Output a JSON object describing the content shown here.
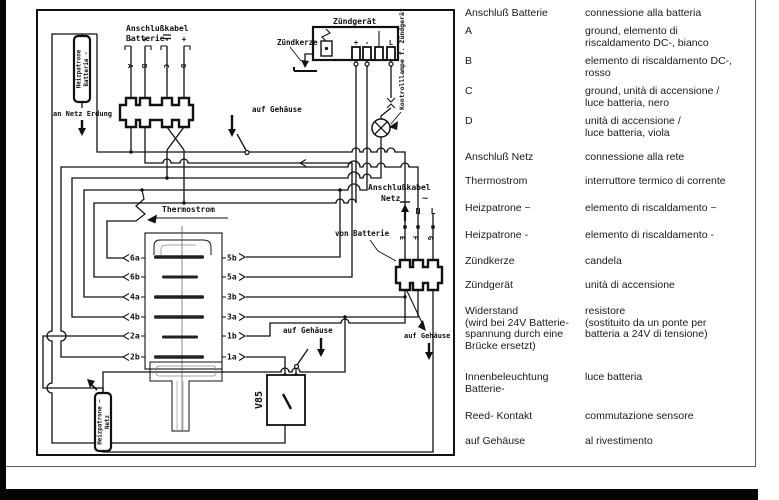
{
  "page": {
    "bg": "#ffffff",
    "ink": "#111111"
  },
  "diagram": {
    "battery_cable": {
      "line1": "Anschlußkabel",
      "line2": "Batterie",
      "polarity": [
        "-",
        "+",
        "-",
        "+"
      ],
      "wires": [
        "A",
        "B",
        "C",
        "D"
      ]
    },
    "earth_label": "an Netz Erdung",
    "battery_heater": {
      "line1": "Heizpatrone",
      "line2": "Batterie -"
    },
    "ignition": {
      "title": "Zündgerät",
      "spark_label": "Zündkerze",
      "terminals": [
        "+",
        "-",
        "L"
      ],
      "lamp_label": "Kontrolllampe f. Zündgerät"
    },
    "thermo_label": "Thermostrom",
    "heater_rows": {
      "left": [
        "6a",
        "6b",
        "4a",
        "4b",
        "2a",
        "2b"
      ],
      "right": [
        "5b",
        "5a",
        "3b",
        "3a",
        "1b",
        "1a"
      ]
    },
    "mains_cable": {
      "line1": "Anschlußkabel",
      "line2": "Netz",
      "ac": "~",
      "n": "N",
      "l": "L",
      "wires": [
        "E",
        "F",
        "G"
      ],
      "from_battery": "von Batterie"
    },
    "case_label": "auf Gehäuse",
    "resistor": "V85",
    "mains_heater": {
      "line1": "Heizpatrone ~",
      "line2": "Netz"
    }
  },
  "legend": {
    "rows": [
      {
        "de": "Anschluß Batterie",
        "it": "connessione alla batteria"
      },
      {
        "de": "A",
        "it": "ground, elemento di\nriscaldamento DC-, bianco"
      },
      {
        "de": "B",
        "it": "elemento di riscaldamento DC-,\nrosso"
      },
      {
        "de": "C",
        "it": "ground, unità di accensione /\nluce batteria, nero"
      },
      {
        "de": "D",
        "it": "unità di accensione /\nluce batteria, viola"
      },
      {
        "de": "Anschluß Netz",
        "it": "connessione alla rete"
      },
      {
        "de": "Thermostrom",
        "it": "interruttore termico di corrente"
      },
      {
        "de": "Heizpatrone ~",
        "it": "elemento di riscaldamento ~"
      },
      {
        "de": "Heizpatrone -",
        "it": "elemento di riscaldamento -"
      },
      {
        "de": "Zündkerze",
        "it": "candela"
      },
      {
        "de": "Zündgerät",
        "it": "unità di accensione"
      },
      {
        "de": "Widerstand\n(wird bei 24V Batterie-\nspannung durch eine\nBrücke ersetzt)",
        "it": "resistore\n(sostituito da un ponte per\nbatteria a 24V di tensione)"
      },
      {
        "de": "Innenbeleuchtung\nBatterie-",
        "it": "luce batteria"
      },
      {
        "de": "Reed- Kontakt",
        "it": "commutazione sensore"
      },
      {
        "de": "auf Gehäuse",
        "it": "al rivestimento"
      }
    ]
  }
}
